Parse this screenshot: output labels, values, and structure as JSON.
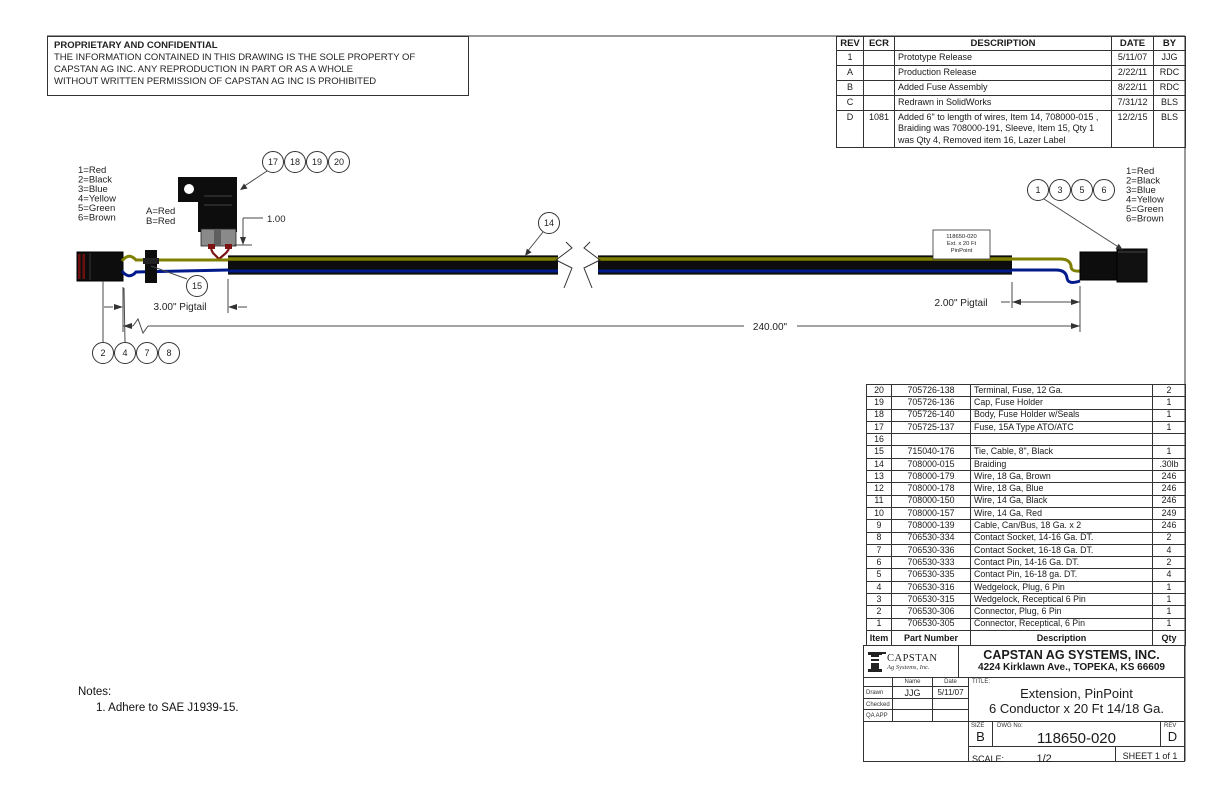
{
  "proprietary": {
    "title": "PROPRIETARY AND CONFIDENTIAL",
    "line1": "THE INFORMATION CONTAINED IN THIS DRAWING IS THE SOLE PROPERTY OF",
    "line2": "CAPSTAN AG INC. ANY REPRODUCTION IN PART OR AS A WHOLE",
    "line3": "WITHOUT WRITTEN PERMISSION OF CAPSTAN AG INC IS PROHIBITED"
  },
  "revision_table": {
    "headers": [
      "REV",
      "ECR",
      "DESCRIPTION",
      "DATE",
      "BY"
    ],
    "rows": [
      {
        "rev": "1",
        "ecr": "",
        "description": "Prototype Release",
        "date": "5/11/07",
        "by": "JJG"
      },
      {
        "rev": "A",
        "ecr": "",
        "description": "Production Release",
        "date": "2/22/11",
        "by": "RDC"
      },
      {
        "rev": "B",
        "ecr": "",
        "description": "Added Fuse Assembly",
        "date": "8/22/11",
        "by": "RDC"
      },
      {
        "rev": "C",
        "ecr": "",
        "description": "Redrawn in SolidWorks",
        "date": "7/31/12",
        "by": "BLS"
      },
      {
        "rev": "D",
        "ecr": "1081",
        "description": "Added 6\" to length of wires, Item 14, 708000-015 , Braiding was 708000-191, Sleeve, Item 15, Qty 1 was Qty 4, Removed item 16, Lazer Label",
        "date": "12/2/15",
        "by": "BLS"
      }
    ]
  },
  "drawing": {
    "left_legend": [
      "1=Red",
      "2=Black",
      "3=Blue",
      "4=Yellow",
      "5=Green",
      "6=Brown"
    ],
    "fuse_legend": [
      "A=Red",
      "B=Red"
    ],
    "right_legend": [
      "1=Red",
      "2=Black",
      "3=Blue",
      "4=Yellow",
      "5=Green",
      "6=Brown"
    ],
    "balloons_fuse": [
      "17",
      "18",
      "19",
      "20"
    ],
    "balloon_tie": "15",
    "balloon_braid": "14",
    "balloons_left_bottom": [
      "2",
      "4",
      "7",
      "8"
    ],
    "balloons_right": [
      "1",
      "3",
      "5",
      "6"
    ],
    "dim_fuse_height": "1.00",
    "dim_left_pigtail": "3.00\" Pigtail",
    "dim_right_pigtail": "2.00\" Pigtail",
    "dim_overall": "240.00\"",
    "cable_label": [
      "118650-020",
      "Ext. x 20 Ft",
      "PinPoint"
    ]
  },
  "notes": {
    "title": "Notes:",
    "item1": "1.  Adhere to SAE J1939-15."
  },
  "bom": {
    "headers": [
      "Item",
      "Part Number",
      "Description",
      "Qty"
    ],
    "rows": [
      [
        "20",
        "705726-138",
        "Terminal, Fuse, 12 Ga.",
        "2"
      ],
      [
        "19",
        "705726-136",
        "Cap, Fuse Holder",
        "1"
      ],
      [
        "18",
        "705726-140",
        "Body, Fuse Holder w/Seals",
        "1"
      ],
      [
        "17",
        "705725-137",
        "Fuse, 15A Type ATO/ATC",
        "1"
      ],
      [
        "16",
        "",
        "",
        ""
      ],
      [
        "15",
        "715040-176",
        "Tie, Cable, 8\", Black",
        "1"
      ],
      [
        "14",
        "708000-015",
        "Braiding",
        ".30lb"
      ],
      [
        "13",
        "708000-179",
        "Wire, 18 Ga, Brown",
        "246"
      ],
      [
        "12",
        "708000-178",
        "Wire, 18 Ga, Blue",
        "246"
      ],
      [
        "11",
        "708000-150",
        "Wire, 14 Ga, Black",
        "246"
      ],
      [
        "10",
        "708000-157",
        "Wire, 14 Ga, Red",
        "249"
      ],
      [
        "9",
        "708000-139",
        "Cable, Can/Bus, 18 Ga. x 2",
        "246"
      ],
      [
        "8",
        "706530-334",
        "Contact Socket, 14-16 Ga. DT.",
        "2"
      ],
      [
        "7",
        "706530-336",
        "Contact Socket, 16-18 Ga. DT.",
        "4"
      ],
      [
        "6",
        "706530-333",
        "Contact Pin, 14-16 Ga. DT.",
        "2"
      ],
      [
        "5",
        "706530-335",
        "Contact Pin, 16-18 ga. DT.",
        "4"
      ],
      [
        "4",
        "706530-316",
        "Wedgelock, Plug, 6 Pin",
        "1"
      ],
      [
        "3",
        "706530-315",
        "Wedgelock, Receptical 6 Pin",
        "1"
      ],
      [
        "2",
        "706530-306",
        "Connector, Plug, 6 Pin",
        "1"
      ],
      [
        "1",
        "706530-305",
        "Connector, Receptical, 6 Pin",
        "1"
      ]
    ]
  },
  "title_block": {
    "logo_name": "CAPSTAN",
    "logo_sub": "Ag Systems, Inc.",
    "company": "CAPSTAN AG SYSTEMS, INC.",
    "address": "4224 Kirklawn Ave., TOPEKA, KS 66609",
    "name_label": "Name",
    "date_label": "Date",
    "drawn_label": "Drawn",
    "drawn_name": "JJG",
    "drawn_date": "5/11/07",
    "checked_label": "Checked",
    "qa_label": "QA APP",
    "title_label": "TITLE:",
    "title_line1": "Extension, PinPoint",
    "title_line2": "6 Conductor x 20 Ft 14/18 Ga.",
    "size_label": "SIZE",
    "size": "B",
    "dwg_label": "DWG No:",
    "dwg_no": "118650-020",
    "rev_label": "REV",
    "rev": "D",
    "scale_label": "SCALE:",
    "scale": "1/2",
    "sheet": "SHEET 1 of 1"
  },
  "colors": {
    "line": "#4a4a4a",
    "object": "#0d0d0d",
    "wire_yellow": "#7f7f00",
    "wire_blue": "#001a8c",
    "wire_red": "#7a1212",
    "terminal_gray": "#8a8a8a"
  }
}
